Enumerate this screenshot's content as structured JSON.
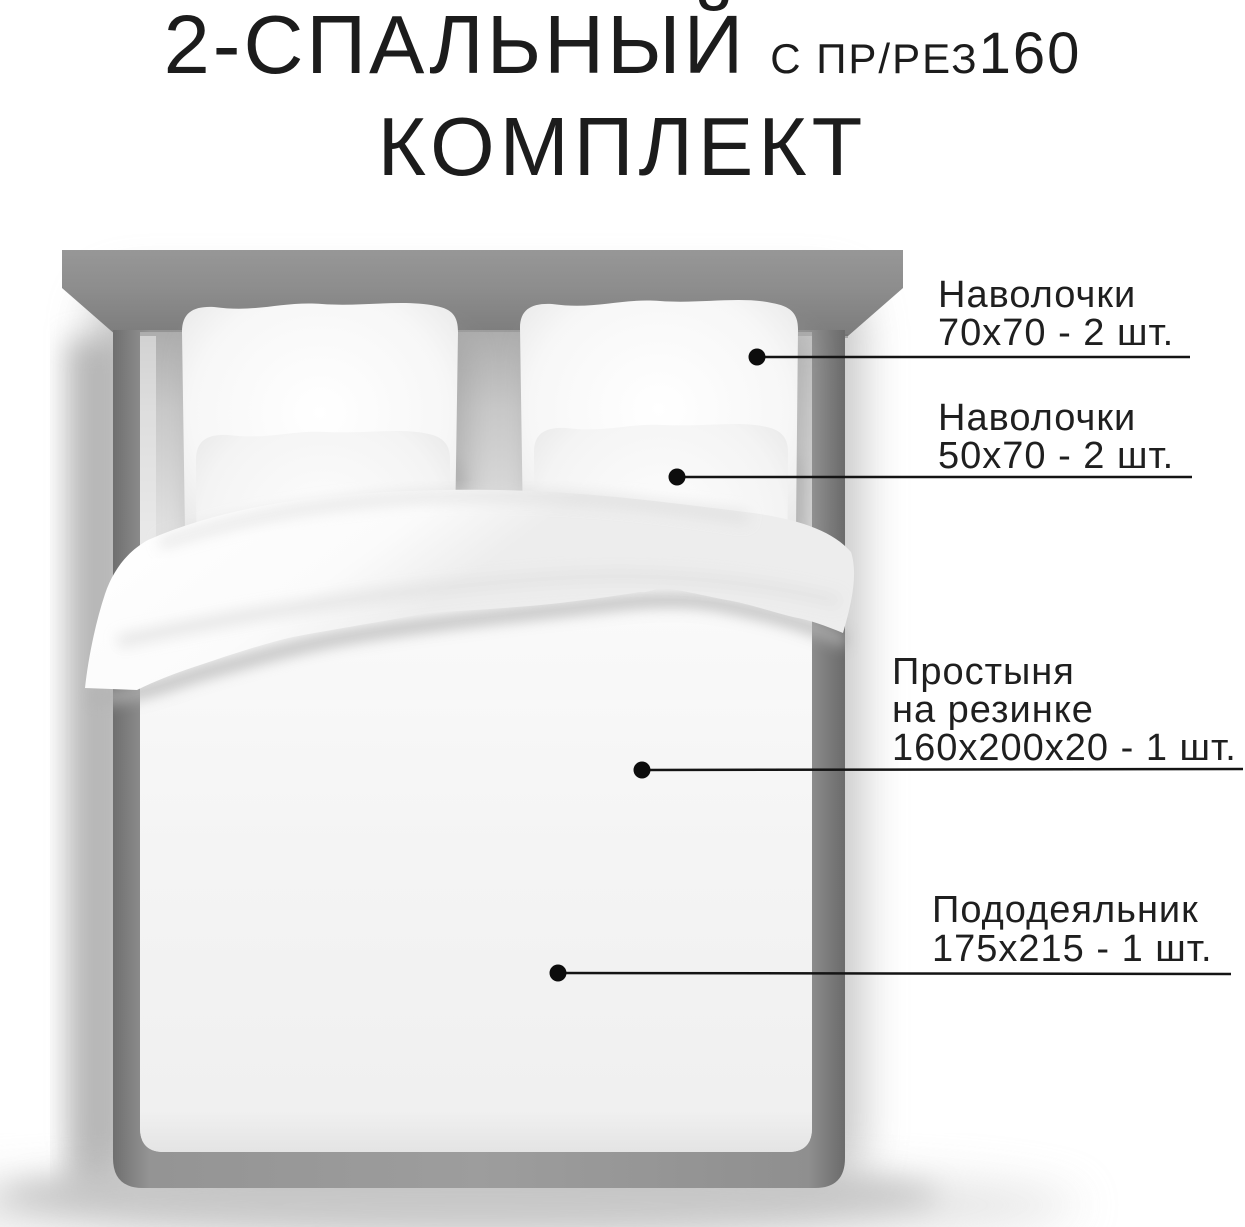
{
  "title": {
    "line1_main": "2-СПАЛЬНЫЙ",
    "line1_suffix": "С ПР/РЕЗ",
    "line1_suffix_number": "160",
    "line2": "КОМПЛЕКТ"
  },
  "callouts": [
    {
      "name": "pillowcases-70",
      "lines": [
        "Наволочки",
        "70х70 - 2 шт."
      ]
    },
    {
      "name": "pillowcases-50",
      "lines": [
        "Наволочки",
        "50х70 - 2 шт."
      ]
    },
    {
      "name": "fitted-sheet",
      "lines": [
        "Простыня",
        "на резинке",
        "160х200х20 - 1 шт."
      ]
    },
    {
      "name": "duvet-cover",
      "lines": [
        "Пододеяльник",
        "175х215 - 1 шт."
      ]
    }
  ],
  "colors": {
    "background": "#ffffff",
    "text": "#1c1c1c",
    "headboard": "#8f8f8f",
    "bed_frame": "#898989",
    "bedding_white": "#f8f8f8",
    "callout_line": "#141414"
  }
}
